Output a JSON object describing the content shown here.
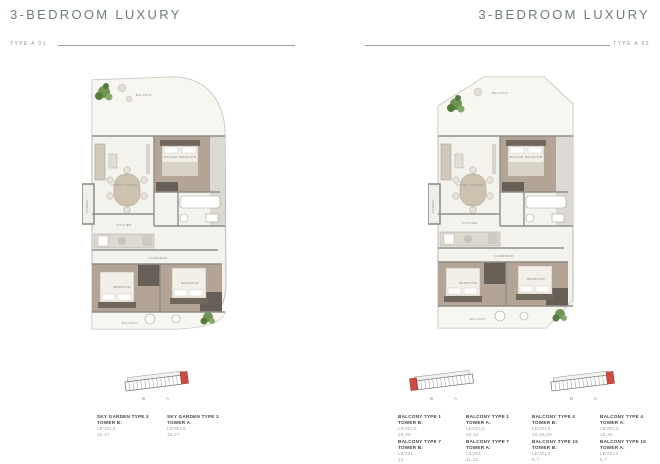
{
  "colors": {
    "accent_red": "#cd4a3e",
    "heading_gray": "#6f7c7a",
    "plan_floor": "#f3f2ec",
    "bedroom_floor": "#b3a496",
    "wardrobe_dark": "#675f55"
  },
  "left_page": {
    "title": "3-BEDROOM LUXURY",
    "type_label": "TYPE A 01",
    "keyplan": {
      "tower_b": "B",
      "tower_a": "A"
    },
    "units": [
      {
        "name": "SKY GARDEN TYPE 2",
        "tower": "TOWER B:",
        "levels_label": "LEVELS",
        "levels": "15,27"
      },
      {
        "name": "SKY GARDEN TYPE 2",
        "tower": "TOWER A:",
        "levels_label": "LEVELS",
        "levels": "15,27"
      }
    ]
  },
  "right_page": {
    "title": "3-BEDROOM LUXURY",
    "type_label": "TYPE A 02",
    "groups": [
      {
        "keyplan": {
          "tower_b": "B",
          "tower_a": "A"
        },
        "units": [
          {
            "name": "BALCONY TYPE 1",
            "tower": "TOWER B:",
            "levels_label": "LEVELS",
            "levels": "25,35"
          },
          {
            "name": "BALCONY TYPE 1",
            "tower": "TOWER A:",
            "levels_label": "LEVELS",
            "levels": "24,34"
          },
          {
            "name": "BALCONY TYPE 7",
            "tower": "TOWER B:",
            "levels_label": "LEVEL",
            "levels": "12"
          },
          {
            "name": "BALCONY TYPE 7",
            "tower": "TOWER A:",
            "levels_label": "LEVEL",
            "levels": "11,12"
          }
        ]
      },
      {
        "keyplan": {
          "tower_b": "B",
          "tower_a": "A"
        },
        "units": [
          {
            "name": "BALCONY TYPE 4",
            "tower": "TOWER B:",
            "levels_label": "LEVELS",
            "levels": "15,25,26"
          },
          {
            "name": "BALCONY TYPE 4",
            "tower": "TOWER A:",
            "levels_label": "LEVELS",
            "levels": "15,25"
          },
          {
            "name": "BALCONY TYPE 15",
            "tower": "TOWER B:",
            "levels_label": "LEVELS",
            "levels": "5,7"
          },
          {
            "name": "BALCONY TYPE 15",
            "tower": "TOWER A:",
            "levels_label": "LEVELS",
            "levels": "5,7"
          }
        ]
      }
    ]
  },
  "plan_rooms": {
    "balcony_top": "BALCONY",
    "living": "LIVING / DINING",
    "master": "MASTER BEDROOM",
    "kitchen": "KITCHEN",
    "corridor": "CORRIDOR",
    "powder": "POWDER",
    "bedroom": "BEDROOM",
    "balcony_bottom": "BALCONY"
  }
}
